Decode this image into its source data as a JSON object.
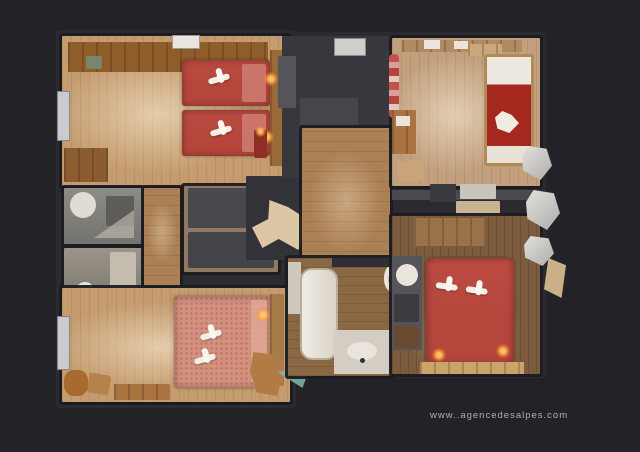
{
  "scene": {
    "description": "Top-down 3D dollhouse scan of a chalet apartment floor plan on a dark background",
    "watermark": "www..agencedesalpes.com"
  },
  "palette": {
    "background": "#232228",
    "wall": "#2b2a31",
    "ghost": "#38373d",
    "floor_light": "#c59c6f",
    "floor_mid": "#ab8054",
    "floor_dark": "#7c5c3e",
    "bed_red": "#b5463c",
    "bed_dark_red": "#a5281f",
    "bed_salmon": "#d4917f",
    "towel_white": "#f2efe8",
    "tile_grey": "#86857f",
    "fixture_white": "#e9e5dc",
    "lamp_glow": "#ffb257",
    "furniture_wood": "#a9743f"
  },
  "objects": [
    "twin-bed",
    "double-bed",
    "single-bed",
    "towel",
    "toilet",
    "bathtub",
    "shower",
    "sink",
    "kitchen-counter",
    "staircase",
    "balcony-chair",
    "radiator",
    "desk",
    "chair",
    "wardrobe",
    "lamp-glow",
    "doormat"
  ]
}
